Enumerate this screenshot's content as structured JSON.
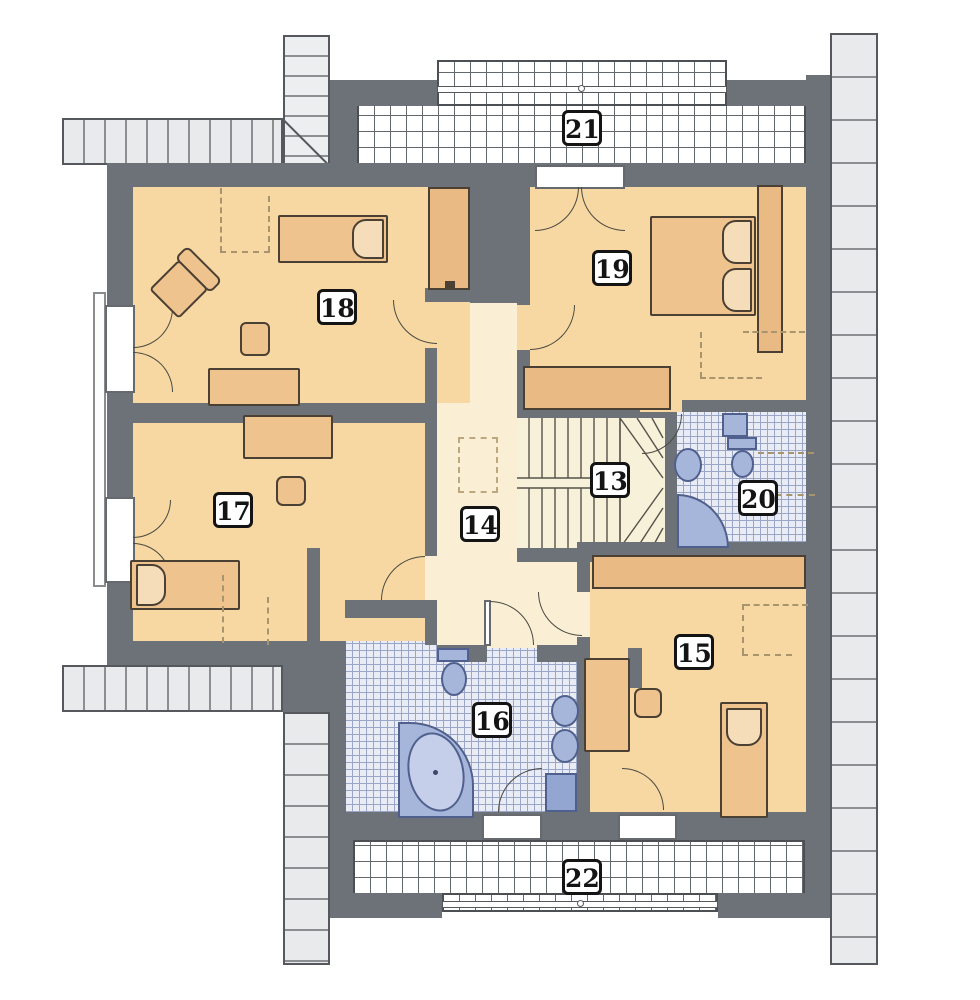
{
  "plan_title": "",
  "rooms": [
    {
      "number": "13"
    },
    {
      "number": "14"
    },
    {
      "number": "15"
    },
    {
      "number": "16"
    },
    {
      "number": "17"
    },
    {
      "number": "18"
    },
    {
      "number": "19"
    },
    {
      "number": "20"
    },
    {
      "number": "21"
    },
    {
      "number": "22"
    }
  ],
  "palette": {
    "wall": "#6d7278",
    "room_floor": "#f8d8a2",
    "corridor_floor": "#faefd4",
    "bathroom_tile": "#e9ecf4",
    "bathroom_tile_line": "#9aa6c8",
    "balcony_tile_line": "#63686d",
    "fixture_blue": "#a6b6da",
    "furniture": "#efc38e",
    "roof_strip": "#e9eaec",
    "label_border": "#141414"
  }
}
